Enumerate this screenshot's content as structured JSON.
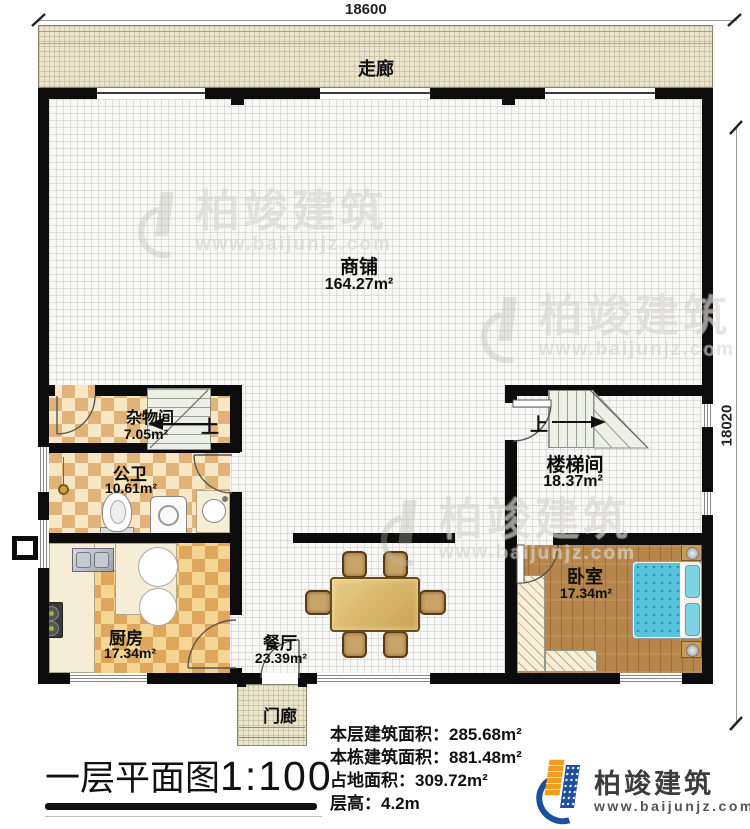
{
  "dimensions": {
    "top": "18600",
    "right": "18020"
  },
  "corridor": {
    "label": "走廊"
  },
  "shop": {
    "label": "商铺",
    "area": "164.27m²"
  },
  "storage": {
    "label": "杂物间",
    "area": "7.05m²"
  },
  "bathroom": {
    "label": "公卫",
    "area": "10.61m²"
  },
  "stairwell": {
    "label": "楼梯间",
    "area": "18.37m²"
  },
  "kitchen": {
    "label": "厨房",
    "area": "17.34m²"
  },
  "dining": {
    "label": "餐厅",
    "area": "23.39m²"
  },
  "bedroom": {
    "label": "卧室",
    "area": "17.34m²"
  },
  "porch": {
    "label": "门廊"
  },
  "stairs": {
    "up": "上"
  },
  "info": {
    "rows": [
      {
        "label": "本层建筑面积：",
        "value": "285.68m²"
      },
      {
        "label": "本栋建筑面积：",
        "value": "881.48m²"
      },
      {
        "label": "占地面积：",
        "value": "309.72m²"
      },
      {
        "label": "层高：",
        "value": "4.2m"
      }
    ]
  },
  "title": {
    "text": "一层平面图",
    "scale": "1:100"
  },
  "brand": {
    "name": "柏竣建筑",
    "url": "www.baijunjz.com"
  },
  "watermark": {
    "name": "柏竣建筑",
    "url": "www.baijunjz.com"
  },
  "colors": {
    "wall": "#0c0c0c",
    "corridor_floor": "#eae5cc",
    "checker_dark": "#dfa75b",
    "bed_blue": "#58c4dc",
    "brand_blue": "#1c4f9c",
    "brand_orange": "#f39c1f"
  }
}
